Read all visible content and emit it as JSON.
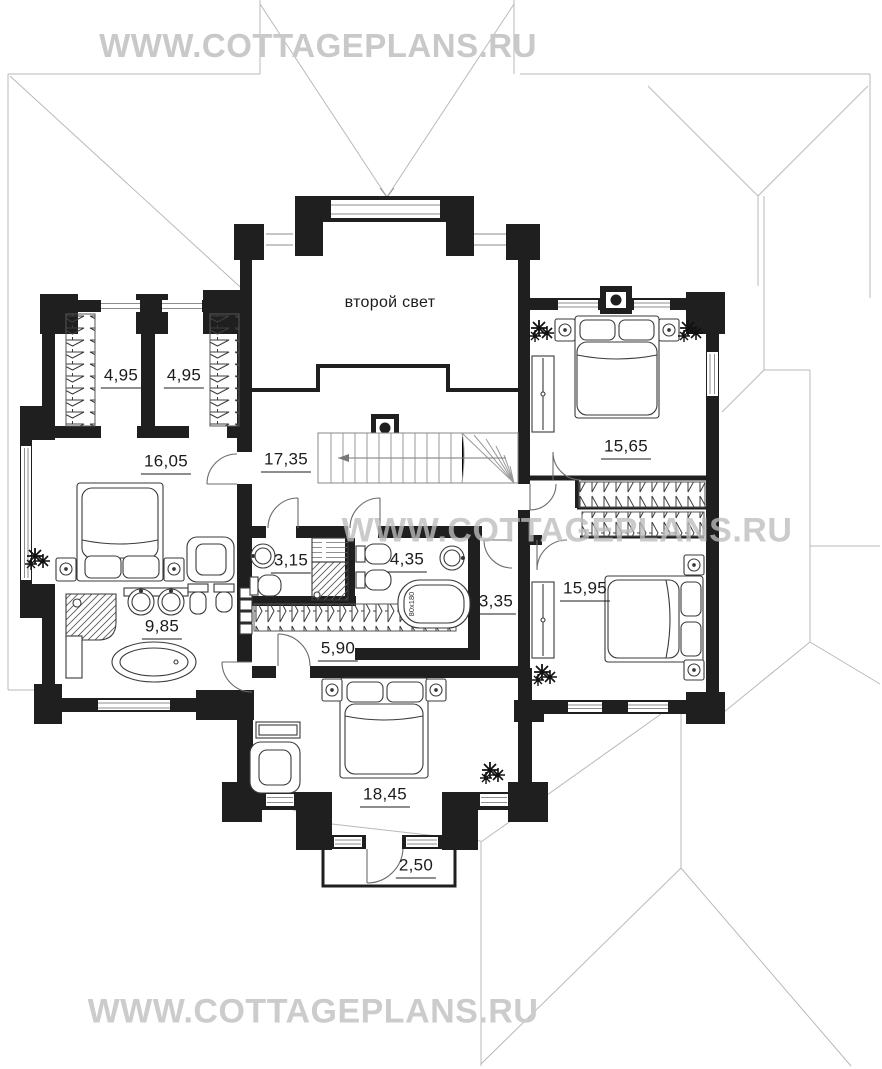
{
  "watermarks": [
    {
      "text": "WWW.COTTAGEPLANS.RU"
    },
    {
      "text": "WWW.COTTAGEPLANS.RU"
    },
    {
      "text": "WWW.COTTAGEPLANS.RU"
    }
  ],
  "plan": {
    "second_light_label": "второй свет",
    "rooms": [
      {
        "id": "closet-1",
        "area": "4,95"
      },
      {
        "id": "closet-2",
        "area": "4,95"
      },
      {
        "id": "bedroom-left",
        "area": "16,05"
      },
      {
        "id": "stair-hall",
        "area": "17,35"
      },
      {
        "id": "bedroom-top-right",
        "area": "15,65"
      },
      {
        "id": "bathroom-small",
        "area": "3,15"
      },
      {
        "id": "bathroom-middle",
        "area": "4,35"
      },
      {
        "id": "hall",
        "area": "3,35"
      },
      {
        "id": "bedroom-bottom-right",
        "area": "15,95"
      },
      {
        "id": "bathroom-left",
        "area": "9,85"
      },
      {
        "id": "wardrobe-corridor",
        "area": "5,90"
      },
      {
        "id": "bedroom-bottom",
        "area": "18,45"
      },
      {
        "id": "balcony",
        "area": "2,50"
      }
    ],
    "fixtures": {
      "bathtub_size": "80x180"
    }
  },
  "colors": {
    "walls": "#1f1f1f",
    "roof_lines": "#b9b9b9",
    "watermark": "#c9c9c9"
  }
}
